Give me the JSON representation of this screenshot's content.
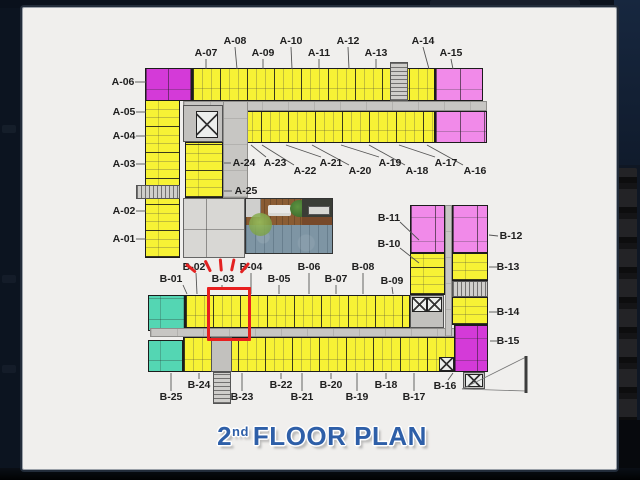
{
  "floor_title": {
    "number": "2",
    "ordinal": "nd",
    "text": "FLOOR PLAN"
  },
  "colors": {
    "unit_yellow": "#f7f235",
    "unit_pink": "#f18ae9",
    "unit_magenta": "#d43ad8",
    "unit_teal": "#54d6b3",
    "corridor_gray": "#c7c6c3",
    "highlight_red": "#e81f1f",
    "title_blue": "#2e5fa8",
    "panel_bg": "#f0efed",
    "frame_bg": "#0c1624"
  },
  "highlight": {
    "unit": "B-03",
    "box": {
      "x": 207,
      "y": 287,
      "w": 38,
      "h": 48
    },
    "dashes": [
      {
        "x": 191,
        "y": 268,
        "rot": -50
      },
      {
        "x": 208,
        "y": 266,
        "rot": -26
      },
      {
        "x": 221,
        "y": 265,
        "rot": -5
      },
      {
        "x": 233,
        "y": 265,
        "rot": 12
      },
      {
        "x": 245,
        "y": 268,
        "rot": 40
      }
    ]
  },
  "labels": [
    {
      "id": "A-06",
      "x": 123,
      "y": 82,
      "leader": [
        135,
        82,
        146,
        82
      ]
    },
    {
      "id": "A-05",
      "x": 124,
      "y": 112,
      "leader": [
        136,
        112,
        146,
        112
      ]
    },
    {
      "id": "A-04",
      "x": 124,
      "y": 136,
      "leader": [
        136,
        136,
        146,
        136
      ]
    },
    {
      "id": "A-03",
      "x": 124,
      "y": 164,
      "leader": [
        136,
        164,
        146,
        164
      ]
    },
    {
      "id": "A-02",
      "x": 124,
      "y": 211,
      "leader": [
        136,
        211,
        146,
        211
      ]
    },
    {
      "id": "A-01",
      "x": 124,
      "y": 239,
      "leader": [
        136,
        239,
        146,
        239
      ]
    },
    {
      "id": "A-07",
      "x": 206,
      "y": 53,
      "leader": [
        206,
        59,
        206,
        69
      ]
    },
    {
      "id": "A-08",
      "x": 235,
      "y": 41,
      "leader": [
        235,
        47,
        237,
        69
      ]
    },
    {
      "id": "A-09",
      "x": 263,
      "y": 53,
      "leader": [
        263,
        59,
        263,
        69
      ]
    },
    {
      "id": "A-10",
      "x": 291,
      "y": 41,
      "leader": [
        291,
        47,
        292,
        69
      ]
    },
    {
      "id": "A-11",
      "x": 319,
      "y": 53,
      "leader": [
        319,
        59,
        319,
        69
      ]
    },
    {
      "id": "A-12",
      "x": 348,
      "y": 41,
      "leader": [
        348,
        47,
        349,
        69
      ]
    },
    {
      "id": "A-13",
      "x": 376,
      "y": 53,
      "leader": [
        376,
        59,
        376,
        69
      ]
    },
    {
      "id": "A-14",
      "x": 423,
      "y": 41,
      "leader": [
        423,
        47,
        429,
        69
      ]
    },
    {
      "id": "A-15",
      "x": 451,
      "y": 53,
      "leader": [
        451,
        59,
        453,
        69
      ]
    },
    {
      "id": "A-24",
      "x": 244,
      "y": 163,
      "leader": [
        231,
        163,
        224,
        163
      ]
    },
    {
      "id": "A-25",
      "x": 246,
      "y": 191,
      "leader": [
        232,
        191,
        224,
        191
      ]
    },
    {
      "id": "A-23",
      "x": 275,
      "y": 163,
      "leader": [
        266,
        157,
        251,
        145
      ]
    },
    {
      "id": "A-22",
      "x": 305,
      "y": 171,
      "leader": [
        294,
        165,
        262,
        145
      ]
    },
    {
      "id": "A-21",
      "x": 331,
      "y": 163,
      "leader": [
        321,
        157,
        286,
        145
      ]
    },
    {
      "id": "A-20",
      "x": 360,
      "y": 171,
      "leader": [
        349,
        165,
        312,
        145
      ]
    },
    {
      "id": "A-19",
      "x": 390,
      "y": 163,
      "leader": [
        379,
        157,
        341,
        145
      ]
    },
    {
      "id": "A-18",
      "x": 417,
      "y": 171,
      "leader": [
        405,
        165,
        369,
        145
      ]
    },
    {
      "id": "A-17",
      "x": 446,
      "y": 163,
      "leader": [
        435,
        157,
        399,
        145
      ]
    },
    {
      "id": "A-16",
      "x": 475,
      "y": 171,
      "leader": [
        463,
        165,
        427,
        145
      ]
    },
    {
      "id": "B-01",
      "x": 171,
      "y": 279,
      "leader": [
        183,
        285,
        187,
        294
      ]
    },
    {
      "id": "B-02",
      "x": 194,
      "y": 267,
      "leader": [
        196,
        273,
        197,
        294
      ]
    },
    {
      "id": "B-03",
      "x": 223,
      "y": 279,
      "leader": [
        222,
        285,
        222,
        287
      ]
    },
    {
      "id": "B-04",
      "x": 251,
      "y": 267,
      "leader": [
        251,
        273,
        251,
        294
      ]
    },
    {
      "id": "B-05",
      "x": 279,
      "y": 279,
      "leader": [
        279,
        285,
        279,
        294
      ]
    },
    {
      "id": "B-06",
      "x": 309,
      "y": 267,
      "leader": [
        309,
        273,
        309,
        294
      ]
    },
    {
      "id": "B-07",
      "x": 336,
      "y": 279,
      "leader": [
        336,
        285,
        336,
        294
      ]
    },
    {
      "id": "B-08",
      "x": 363,
      "y": 267,
      "leader": [
        363,
        273,
        363,
        294
      ]
    },
    {
      "id": "B-09",
      "x": 392,
      "y": 281,
      "leader": [
        392,
        287,
        393,
        294
      ]
    },
    {
      "id": "B-11",
      "x": 389,
      "y": 218,
      "leader": [
        400,
        222,
        419,
        240
      ]
    },
    {
      "id": "B-10",
      "x": 389,
      "y": 244,
      "leader": [
        400,
        248,
        419,
        263
      ]
    },
    {
      "id": "B-12",
      "x": 511,
      "y": 236,
      "leader": [
        498,
        236,
        489,
        235
      ]
    },
    {
      "id": "B-13",
      "x": 508,
      "y": 267,
      "leader": [
        497,
        267,
        489,
        267
      ]
    },
    {
      "id": "B-14",
      "x": 508,
      "y": 312,
      "leader": [
        497,
        312,
        489,
        312
      ]
    },
    {
      "id": "B-15",
      "x": 508,
      "y": 341,
      "leader": [
        497,
        341,
        490,
        341
      ]
    },
    {
      "id": "B-24",
      "x": 199,
      "y": 385,
      "leader": [
        199,
        379,
        199,
        373
      ]
    },
    {
      "id": "B-22",
      "x": 281,
      "y": 385,
      "leader": [
        281,
        379,
        281,
        373
      ]
    },
    {
      "id": "B-20",
      "x": 331,
      "y": 385,
      "leader": [
        331,
        379,
        331,
        373
      ]
    },
    {
      "id": "B-18",
      "x": 386,
      "y": 385,
      "leader": [
        386,
        379,
        386,
        373
      ]
    },
    {
      "id": "B-16",
      "x": 445,
      "y": 386,
      "leader": [
        448,
        380,
        453,
        373
      ]
    },
    {
      "id": "B-25",
      "x": 171,
      "y": 397,
      "leader": [
        171,
        391,
        171,
        373
      ]
    },
    {
      "id": "B-23",
      "x": 242,
      "y": 397,
      "leader": [
        242,
        391,
        242,
        373
      ]
    },
    {
      "id": "B-21",
      "x": 302,
      "y": 397,
      "leader": [
        302,
        391,
        302,
        373
      ]
    },
    {
      "id": "B-19",
      "x": 357,
      "y": 397,
      "leader": [
        357,
        391,
        357,
        373
      ]
    },
    {
      "id": "B-17",
      "x": 414,
      "y": 397,
      "leader": [
        414,
        391,
        414,
        373
      ]
    }
  ]
}
